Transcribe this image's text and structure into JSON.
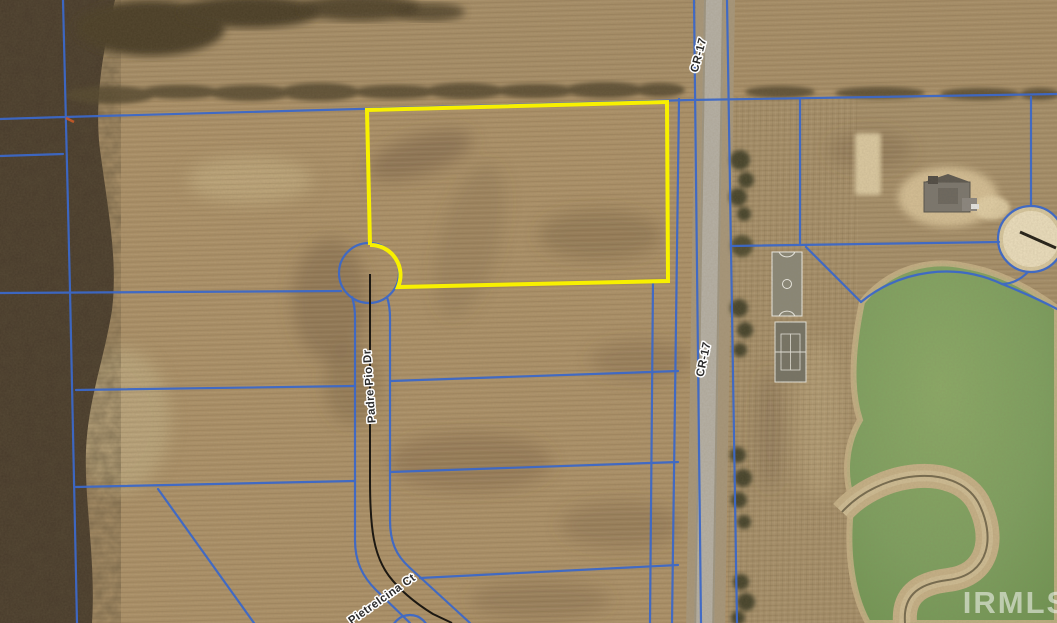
{
  "map": {
    "description": "Aerial parcel map with highlighted vacant lot",
    "watermark": "IRMLS",
    "road_labels": {
      "cr17_north": "CR-17",
      "cr17_south": "CR-17",
      "padre_pio_dr": "Padre Pio Dr",
      "pietrelcina_ct": "Pietrelcina Ct"
    },
    "highlighted_lot": {
      "outline_color": "#f8f000"
    },
    "colors": {
      "parcel_line_blue": "#3c68c8",
      "field_tan": "#ac9168",
      "woods_dark": "#46392a",
      "pond_green": "#7da05f",
      "sand_light": "#e9dcba",
      "pavement_gray": "#b6b1a6",
      "street_centerline_black": "#1c1812",
      "watermark_white": "#fafaf8",
      "survey_mark_orange": "#c85a28"
    },
    "features": {
      "pond": "pond",
      "sand_circle": "circular-sand-area",
      "house": "house-under-construction",
      "basketball_court": "basketball-court",
      "tennis_court": "tennis-court",
      "cul_de_sac": "cul-de-sac",
      "woods": "wooded-area"
    }
  }
}
